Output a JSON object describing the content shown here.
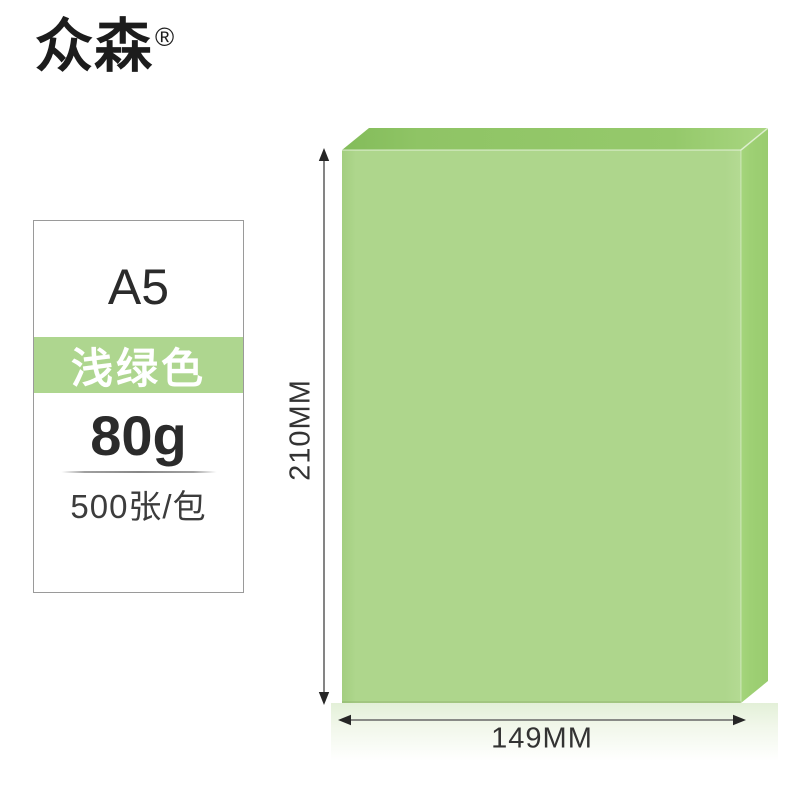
{
  "brand": {
    "name": "众森",
    "registered_mark": "®"
  },
  "product_card": {
    "size": "A5",
    "color_name": "浅绿色",
    "weight": "80g",
    "quantity": "500张/包"
  },
  "dimensions": {
    "height_label": "210MM",
    "width_label": "149MM"
  },
  "colors": {
    "paper-front": "#aed68c",
    "paper-top": "#90c566",
    "paper-side": "#9ed074",
    "band-bg": "#aed68f",
    "card-border": "#9a9a9a",
    "arrow": "#666666"
  }
}
